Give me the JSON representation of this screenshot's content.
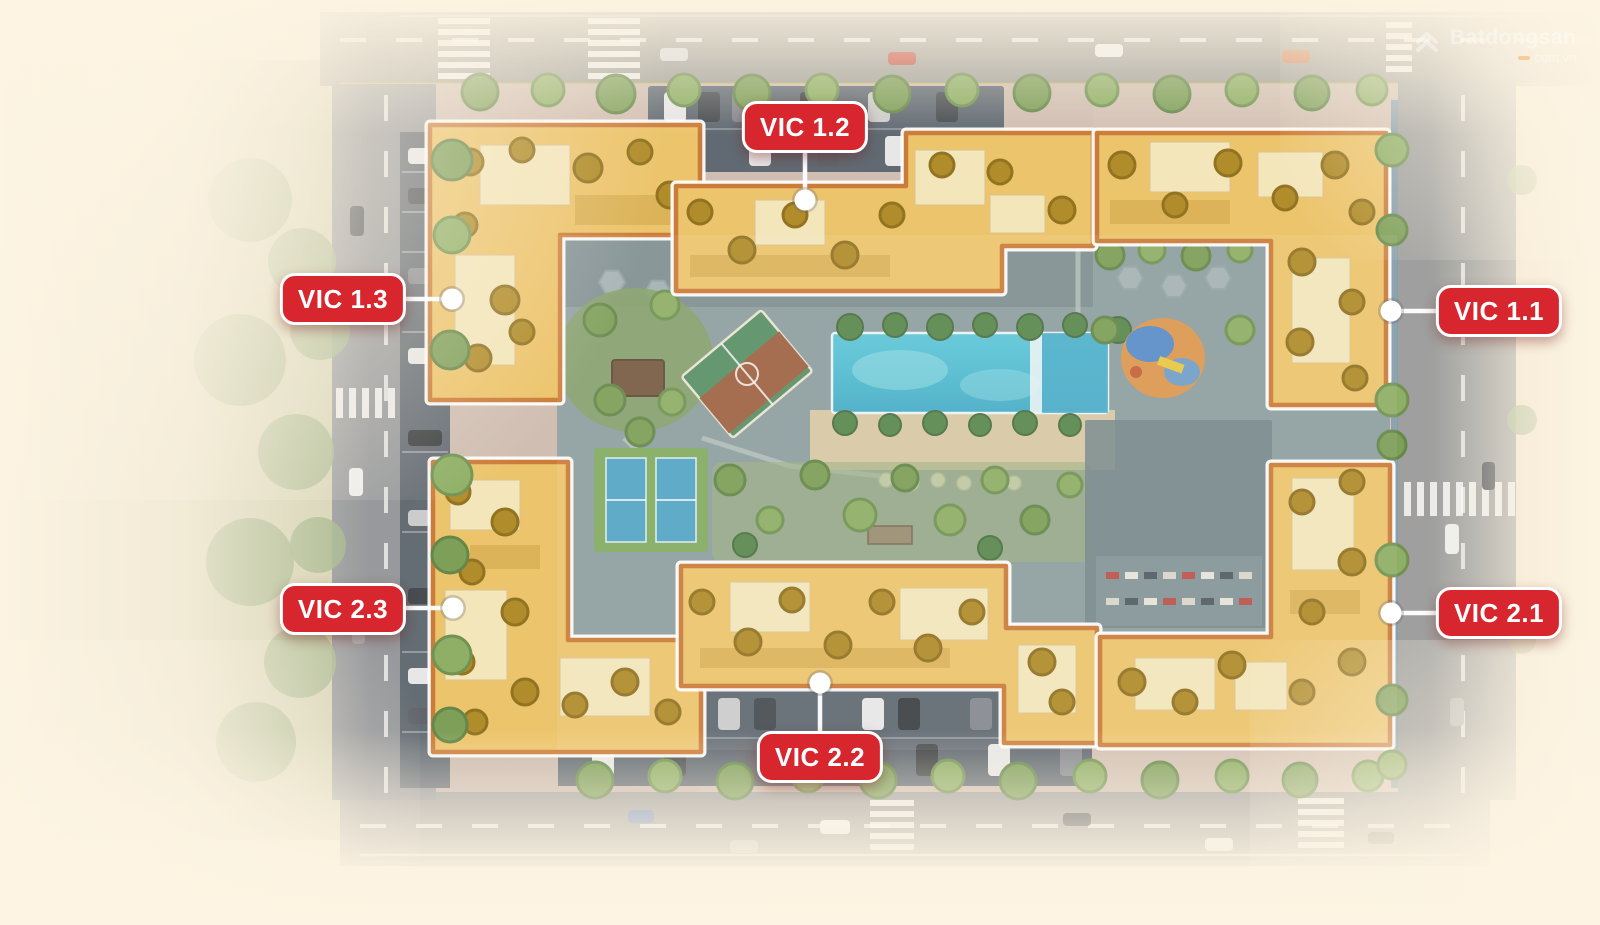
{
  "labels": [
    {
      "id": "vic-1-2",
      "text": "VIC 1.2"
    },
    {
      "id": "vic-1-3",
      "text": "VIC 1.3"
    },
    {
      "id": "vic-1-1",
      "text": "VIC 1.1"
    },
    {
      "id": "vic-2-3",
      "text": "VIC 2.3"
    },
    {
      "id": "vic-2-2",
      "text": "VIC 2.2"
    },
    {
      "id": "vic-2-1",
      "text": "VIC 2.1"
    }
  ],
  "watermark": {
    "brand": "Batdongsan",
    "suffix": "com.vn"
  },
  "colors": {
    "badge_background": "#d8262e",
    "badge_border": "#ffffff",
    "badge_text": "#ffffff",
    "building_roof_gold": "#ecc264",
    "building_border_orange": "#c8742e",
    "pool_water_turquoise": "#45b9d1",
    "courtyard_paving_teal": "#87999d",
    "road_gray": "#9a9a97",
    "tree_canopy_green": "#74994f",
    "vignette_cream": "#fdf4e3"
  }
}
